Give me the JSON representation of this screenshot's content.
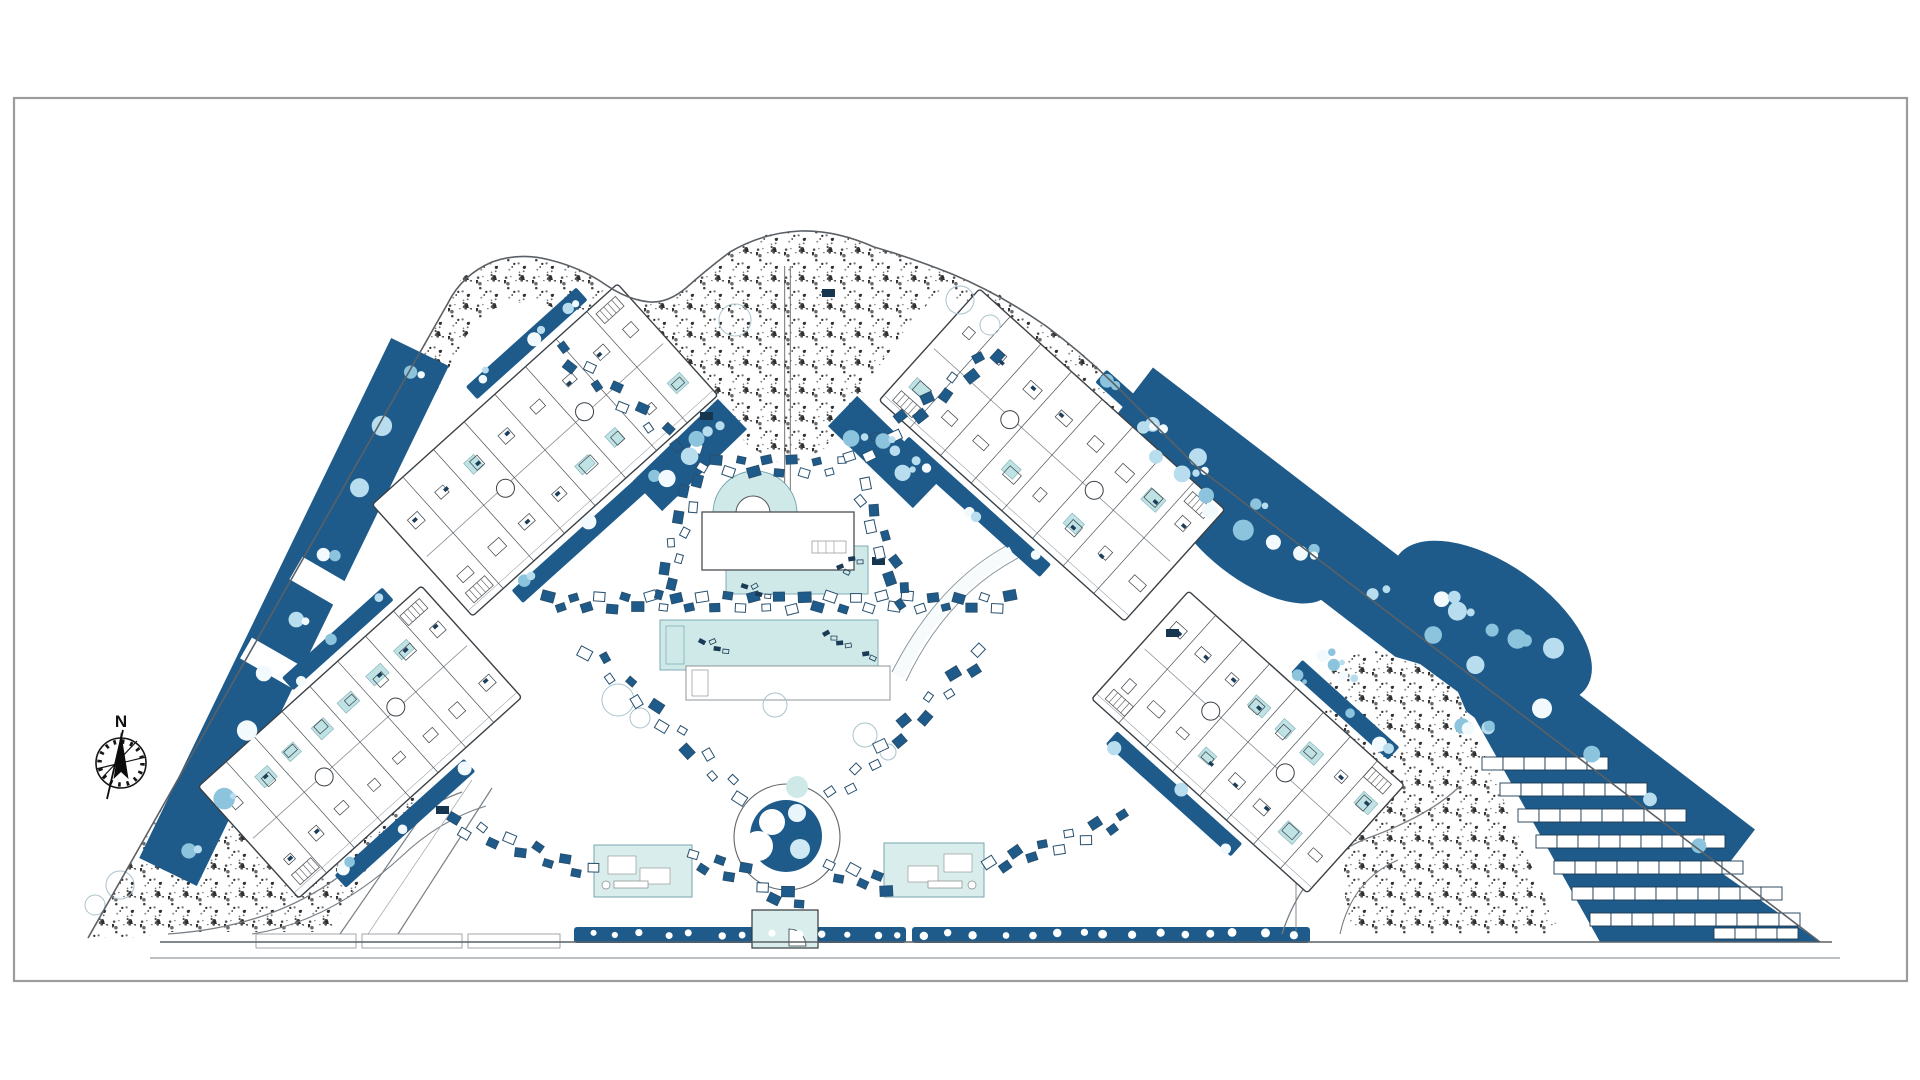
{
  "drawing": {
    "kind": "architectural resort site plan",
    "compass": {
      "label": "N"
    },
    "palette": {
      "paper": "#ffffff",
      "frame_border": "#9b9b9b",
      "landscape_blue": "#1e5b8a",
      "pool_cyan": "#cfe9e9",
      "pavilion_cyan": "#d8edec",
      "unit_pool_cyan": "#bfe2e4",
      "tree_white": "#f2fafd",
      "tree_light_blue": "#b7ddef",
      "tree_mid_blue": "#8cc4dd",
      "outline_dark": "#3a4045",
      "wall_dark": "#22262a",
      "stipple_dot": "#2d2d2d",
      "faint_tree_outline": "#a9c3cc"
    },
    "buildings": {
      "count": 4,
      "blocks": [
        "upper-left",
        "lower-left",
        "upper-right",
        "lower-right"
      ]
    },
    "amenities": [
      "semicircular pool",
      "clubhouse",
      "upper pool",
      "main lap pool",
      "sun deck",
      "circular plaza",
      "left pavilion",
      "right pavilion",
      "entrance kiosk",
      "sun lounger rows"
    ],
    "parking": {
      "location": "bottom-right",
      "rows": [
        6,
        7,
        8,
        9,
        9,
        10,
        10
      ],
      "edge_row_stalls": 4
    }
  }
}
